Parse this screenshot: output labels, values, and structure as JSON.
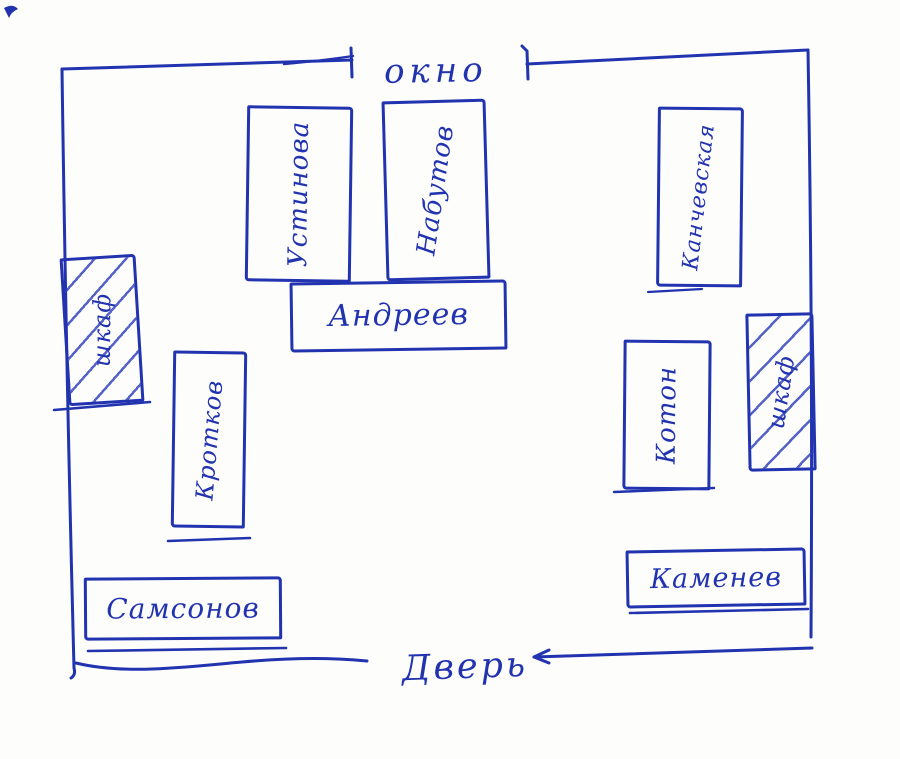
{
  "palette": {
    "ink": "#2233b0",
    "paper": "#fdfdfb"
  },
  "plan": {
    "type": "hand-drawn classroom seating plan",
    "window_label": "окно",
    "door_label": "Дверь",
    "labels": {
      "ustinova": "Устинова",
      "nabutov": "Набутов",
      "andreev": "Андреев",
      "kanchevskaya": "Канчевская",
      "wardrobe_left": "шкаф",
      "krotkov": "Кротков",
      "koton": "Котон",
      "wardrobe_right": "шкаф",
      "samsonov": "Самсонов",
      "kamenev": "Каменев"
    }
  }
}
